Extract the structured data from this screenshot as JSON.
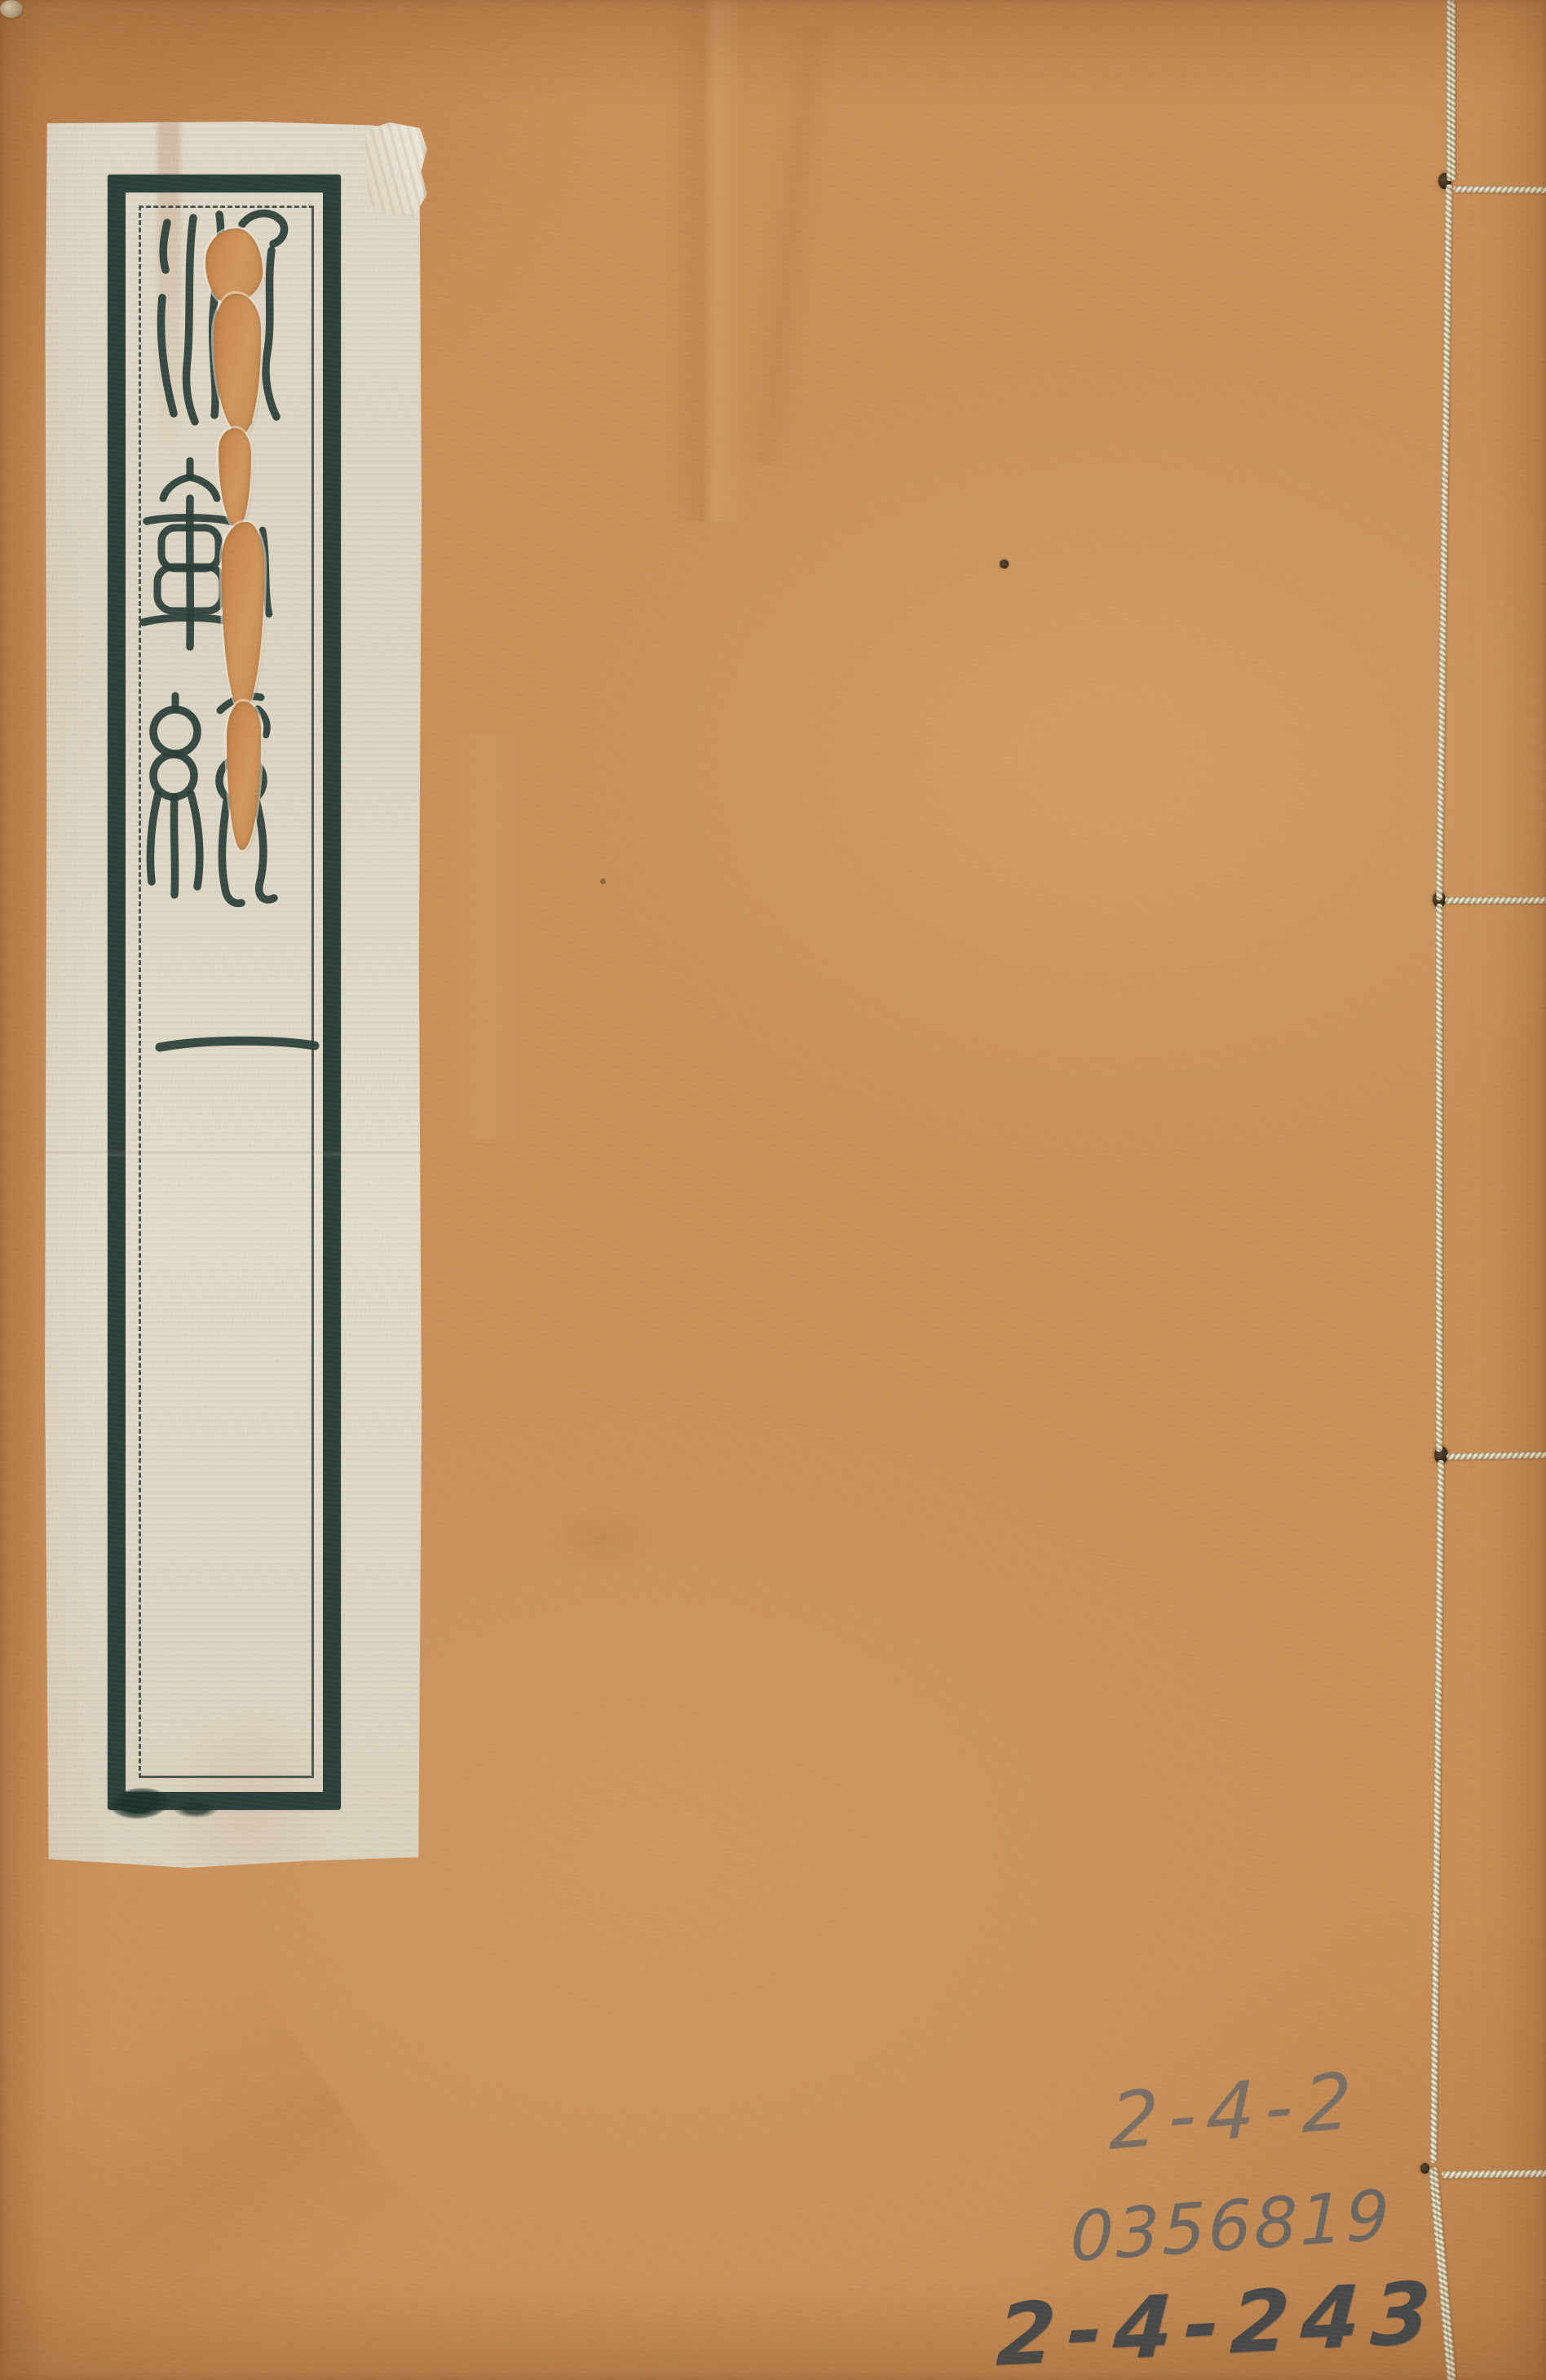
{
  "document": {
    "kind": "Scanned front cover of a Chinese thread-bound (stab-stitched) book",
    "material": "orange-brown kraft paper cover with a pasted cream paper title slip"
  },
  "title_label": {
    "script_style": "seal script printed in dark blue-green ink inside a double-rule frame",
    "characters": [
      "法",
      "軌",
      "統"
    ],
    "volume_marker": "一",
    "condition": "worm damage / tear through the slip exposing the orange cover beneath"
  },
  "binding": {
    "style": "four-hole stab binding",
    "stations": 4,
    "thread_color": "#d8cdab"
  },
  "annotations": {
    "medium": "handwritten pencil, lower right corner",
    "line1": "2-4-2",
    "line2": "0356819",
    "line3": "2-4-243"
  },
  "colors": {
    "cover": "#c98f58",
    "label_paper": "#ded6c4",
    "frame_ink": "#2c403a",
    "pencil": "#565c61"
  }
}
